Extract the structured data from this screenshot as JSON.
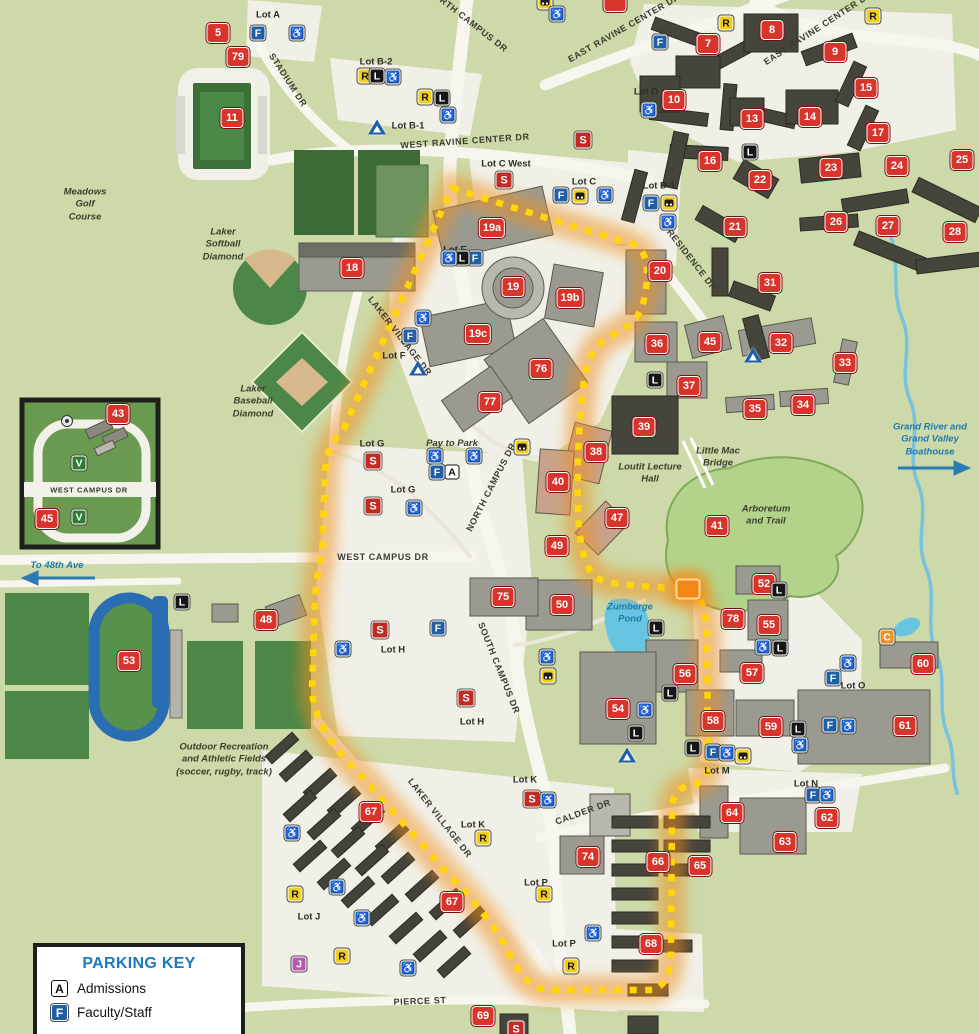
{
  "map": {
    "width": 979,
    "height": 1034
  },
  "colors": {
    "map_green": "#cdd9a8",
    "road_white": "#f6f5ee",
    "field_green": "#4c8747",
    "golf_green": "#3c6b35",
    "building_gray": "#9b9a90",
    "building_dark": "#46453c",
    "badge_red": "#d8342c",
    "badge_blue": "#1f5fa8",
    "badge_yellow": "#f2cf1d",
    "badge_black": "#161616",
    "badge_green": "#2e7d32",
    "badge_purple": "#b55bb5",
    "badge_orange": "#e8922a",
    "route_yellow": "#ffd60a",
    "route_glow": "#ef8e1b",
    "water_blue": "#68c5e2",
    "track_blue": "#2a6db3",
    "label_blue": "#1d7ab0"
  },
  "roads": [
    {
      "label": "NORTH CAMPUS DR",
      "x": 468,
      "y": 20,
      "rot": 38
    },
    {
      "label": "EAST RAVINE CENTER DR",
      "x": 818,
      "y": 28,
      "rot": -33
    },
    {
      "label": "EAST RAVINE CENTER DR",
      "x": 624,
      "y": 28,
      "rot": -30
    },
    {
      "label": "WEST RAVINE CENTER DR",
      "x": 465,
      "y": 141,
      "rot": -4
    },
    {
      "label": "STADIUM DR",
      "x": 288,
      "y": 80,
      "rot": 57
    },
    {
      "label": "RESIDENCE DR",
      "x": 692,
      "y": 260,
      "rot": 52
    },
    {
      "label": "NORTH CAMPUS DR",
      "x": 491,
      "y": 487,
      "rot": -63
    },
    {
      "label": "SOUTH CAMPUS DR",
      "x": 499,
      "y": 668,
      "rot": 68
    },
    {
      "label": "WEST CAMPUS DR",
      "x": 383,
      "y": 557,
      "rot": 0
    },
    {
      "label": "LAKER VILLAGE DR",
      "x": 400,
      "y": 336,
      "rot": 52
    },
    {
      "label": "LAKER VILLAGE DR",
      "x": 440,
      "y": 818,
      "rot": 52
    },
    {
      "label": "CALDER DR",
      "x": 583,
      "y": 812,
      "rot": -20
    },
    {
      "label": "PIERCE ST",
      "x": 420,
      "y": 1001,
      "rot": -2
    },
    {
      "label": "WEST CAMPUS DR",
      "x": 89,
      "y": 490,
      "rot": 0,
      "size": 7.5
    }
  ],
  "lots": [
    {
      "label": "Lot A",
      "x": 268,
      "y": 15
    },
    {
      "label": "Lot B-2",
      "x": 376,
      "y": 62
    },
    {
      "label": "Lot B-1",
      "x": 408,
      "y": 126
    },
    {
      "label": "Lot C West",
      "x": 506,
      "y": 164
    },
    {
      "label": "Lot C",
      "x": 584,
      "y": 182
    },
    {
      "label": "Lot D",
      "x": 646,
      "y": 92
    },
    {
      "label": "Lot D-1",
      "x": 659,
      "y": 186
    },
    {
      "label": "Lot E",
      "x": 455,
      "y": 250
    },
    {
      "label": "Lot F",
      "x": 394,
      "y": 356
    },
    {
      "label": "Lot G",
      "x": 372,
      "y": 444
    },
    {
      "label": "Lot G",
      "x": 403,
      "y": 490
    },
    {
      "label": "Lot H",
      "x": 393,
      "y": 650
    },
    {
      "label": "Lot H",
      "x": 472,
      "y": 722
    },
    {
      "label": "Lot J",
      "x": 309,
      "y": 917
    },
    {
      "label": "Lot K",
      "x": 525,
      "y": 780
    },
    {
      "label": "Lot K",
      "x": 473,
      "y": 825
    },
    {
      "label": "Lot M",
      "x": 717,
      "y": 771
    },
    {
      "label": "Lot N",
      "x": 806,
      "y": 784
    },
    {
      "label": "Lot O",
      "x": 853,
      "y": 686
    },
    {
      "label": "Lot P",
      "x": 536,
      "y": 883
    },
    {
      "label": "Lot P",
      "x": 564,
      "y": 944
    }
  ],
  "places": [
    {
      "label": "Meadows\nGolf\nCourse",
      "x": 85,
      "y": 205,
      "color": "#3a3f2c"
    },
    {
      "label": "Laker\nSoftball\nDiamond",
      "x": 223,
      "y": 245,
      "color": "#3a3f2c"
    },
    {
      "label": "Laker\nBaseball\nDiamond",
      "x": 253,
      "y": 402,
      "color": "#3a3f2c"
    },
    {
      "label": "Loutit Lecture\nHall",
      "x": 650,
      "y": 474,
      "color": "#3a3f2c"
    },
    {
      "label": "Little Mac\nBridge",
      "x": 718,
      "y": 458,
      "color": "#3a3f2c"
    },
    {
      "label": "Arboretum\nand Trail",
      "x": 766,
      "y": 516,
      "color": "#3a3f2c"
    },
    {
      "label": "Grand River and\nGrand Valley\nBoathouse",
      "x": 930,
      "y": 440,
      "color": "#1d7ab0"
    },
    {
      "label": "Zumberge\nPond",
      "x": 630,
      "y": 614,
      "color": "#1d7ab0"
    },
    {
      "label": "To 48th Ave",
      "x": 57,
      "y": 566,
      "color": "#1d7ab0"
    },
    {
      "label": "Outdoor Recreation\nand Athletic Fields\n(soccer, rugby, track)",
      "x": 224,
      "y": 760,
      "color": "#3a3f2c"
    },
    {
      "label": "Pay to Park",
      "x": 452,
      "y": 444,
      "color": "#3a3f2c"
    }
  ],
  "badges": [
    [
      "n",
      "5",
      218,
      33
    ],
    [
      "n",
      "79",
      238,
      57
    ],
    [
      "n",
      "11",
      232,
      118
    ],
    [
      "n",
      "18",
      352,
      268
    ],
    [
      "n",
      "19a",
      492,
      228
    ],
    [
      "n",
      "19",
      513,
      287
    ],
    [
      "n",
      "19b",
      570,
      298
    ],
    [
      "n",
      "19c",
      478,
      334
    ],
    [
      "n",
      "76",
      541,
      369
    ],
    [
      "n",
      "77",
      490,
      402
    ],
    [
      "n",
      "7",
      708,
      44
    ],
    [
      "n",
      "8",
      772,
      30
    ],
    [
      "n",
      "9",
      835,
      52
    ],
    [
      "n",
      "10",
      674,
      100
    ],
    [
      "n",
      "13",
      752,
      119
    ],
    [
      "n",
      "14",
      810,
      117
    ],
    [
      "n",
      "15",
      866,
      88
    ],
    [
      "n",
      "16",
      710,
      161
    ],
    [
      "n",
      "17",
      878,
      133
    ],
    [
      "n",
      "20",
      660,
      271
    ],
    [
      "n",
      "21",
      735,
      227
    ],
    [
      "n",
      "22",
      760,
      180
    ],
    [
      "n",
      "23",
      831,
      168
    ],
    [
      "n",
      "24",
      897,
      166
    ],
    [
      "n",
      "25",
      962,
      160
    ],
    [
      "n",
      "26",
      836,
      222
    ],
    [
      "n",
      "27",
      888,
      226
    ],
    [
      "n",
      "28",
      955,
      232
    ],
    [
      "n",
      "31",
      770,
      283
    ],
    [
      "n",
      "32",
      781,
      343
    ],
    [
      "n",
      "33",
      845,
      363
    ],
    [
      "n",
      "34",
      803,
      405
    ],
    [
      "n",
      "35",
      755,
      409
    ],
    [
      "n",
      "36",
      657,
      344
    ],
    [
      "n",
      "37",
      689,
      386
    ],
    [
      "n",
      "38",
      596,
      452
    ],
    [
      "n",
      "39",
      644,
      427
    ],
    [
      "n",
      "40",
      558,
      482
    ],
    [
      "n",
      "41",
      717,
      526
    ],
    [
      "n",
      "43",
      118,
      414
    ],
    [
      "n",
      "45",
      710,
      342
    ],
    [
      "n",
      "45",
      47,
      519
    ],
    [
      "n",
      "47",
      617,
      518
    ],
    [
      "n",
      "48",
      266,
      620
    ],
    [
      "n",
      "49",
      557,
      546
    ],
    [
      "n",
      "50",
      562,
      605
    ],
    [
      "n",
      "52",
      764,
      584
    ],
    [
      "n",
      "53",
      129,
      661
    ],
    [
      "n",
      "54",
      618,
      709
    ],
    [
      "n",
      "55",
      769,
      625
    ],
    [
      "n",
      "56",
      685,
      674
    ],
    [
      "n",
      "57",
      752,
      673
    ],
    [
      "n",
      "58",
      713,
      721
    ],
    [
      "n",
      "59",
      771,
      727
    ],
    [
      "n",
      "60",
      923,
      664
    ],
    [
      "n",
      "61",
      905,
      726
    ],
    [
      "n",
      "62",
      827,
      818
    ],
    [
      "n",
      "63",
      785,
      842
    ],
    [
      "n",
      "64",
      732,
      813
    ],
    [
      "n",
      "65",
      700,
      866
    ],
    [
      "n",
      "66",
      658,
      862
    ],
    [
      "n",
      "67",
      371,
      812
    ],
    [
      "n",
      "67",
      452,
      902
    ],
    [
      "n",
      "68",
      651,
      944
    ],
    [
      "n",
      "69",
      483,
      1016
    ],
    [
      "n",
      "74",
      588,
      857
    ],
    [
      "n",
      "75",
      503,
      597
    ],
    [
      "n",
      "78",
      733,
      619
    ],
    [
      "n",
      "",
      615,
      2
    ],
    [
      "g",
      "",
      688,
      589
    ],
    [
      "s",
      "S",
      583,
      140
    ],
    [
      "s",
      "S",
      504,
      180
    ],
    [
      "s",
      "S",
      373,
      461
    ],
    [
      "s",
      "S",
      373,
      506
    ],
    [
      "s",
      "S",
      380,
      630
    ],
    [
      "s",
      "S",
      466,
      698
    ],
    [
      "s",
      "S",
      532,
      799
    ],
    [
      "s",
      "S",
      516,
      1029
    ],
    [
      "f",
      "F",
      258,
      33
    ],
    [
      "f",
      "F",
      660,
      42
    ],
    [
      "f",
      "F",
      561,
      195
    ],
    [
      "f",
      "F",
      651,
      203
    ],
    [
      "f",
      "F",
      475,
      258
    ],
    [
      "f",
      "F",
      410,
      336
    ],
    [
      "f",
      "F",
      437,
      472
    ],
    [
      "f",
      "F",
      438,
      628
    ],
    [
      "f",
      "F",
      833,
      678
    ],
    [
      "f",
      "F",
      830,
      725
    ],
    [
      "f",
      "F",
      713,
      752
    ],
    [
      "f",
      "F",
      813,
      795
    ],
    [
      "r",
      "R",
      365,
      76
    ],
    [
      "r",
      "R",
      425,
      97
    ],
    [
      "r",
      "R",
      726,
      23
    ],
    [
      "r",
      "R",
      873,
      16
    ],
    [
      "r",
      "R",
      483,
      838
    ],
    [
      "r",
      "R",
      544,
      894
    ],
    [
      "r",
      "R",
      571,
      966
    ],
    [
      "r",
      "R",
      295,
      894
    ],
    [
      "r",
      "R",
      342,
      956
    ],
    [
      "l",
      "L",
      377,
      76
    ],
    [
      "l",
      "L",
      442,
      98
    ],
    [
      "l",
      "L",
      750,
      152
    ],
    [
      "l",
      "L",
      182,
      602
    ],
    [
      "l",
      "L",
      462,
      258
    ],
    [
      "l",
      "L",
      655,
      380
    ],
    [
      "l",
      "L",
      656,
      628
    ],
    [
      "l",
      "L",
      779,
      590
    ],
    [
      "l",
      "L",
      780,
      648
    ],
    [
      "l",
      "L",
      670,
      693
    ],
    [
      "l",
      "L",
      636,
      733
    ],
    [
      "l",
      "L",
      693,
      748
    ],
    [
      "l",
      "L",
      798,
      729
    ],
    [
      "a",
      "A",
      452,
      472
    ],
    [
      "v",
      "V",
      79,
      463
    ],
    [
      "v",
      "V",
      79,
      517
    ],
    [
      "j",
      "J",
      299,
      964
    ],
    [
      "c",
      "C",
      887,
      637
    ],
    [
      "b",
      "",
      545,
      2
    ],
    [
      "b",
      "",
      580,
      196
    ],
    [
      "b",
      "",
      669,
      203
    ],
    [
      "b",
      "",
      522,
      447
    ],
    [
      "b",
      "",
      548,
      676
    ],
    [
      "b",
      "",
      743,
      756
    ],
    [
      "w",
      "",
      297,
      33
    ],
    [
      "w",
      "",
      557,
      14
    ],
    [
      "w",
      "",
      393,
      77
    ],
    [
      "w",
      "",
      448,
      115
    ],
    [
      "w",
      "",
      605,
      195
    ],
    [
      "w",
      "",
      649,
      110
    ],
    [
      "w",
      "",
      668,
      222
    ],
    [
      "w",
      "",
      449,
      258
    ],
    [
      "w",
      "",
      423,
      318
    ],
    [
      "w",
      "",
      435,
      456
    ],
    [
      "w",
      "",
      474,
      456
    ],
    [
      "w",
      "",
      414,
      508
    ],
    [
      "w",
      "",
      343,
      649
    ],
    [
      "w",
      "",
      547,
      657
    ],
    [
      "w",
      "",
      645,
      710
    ],
    [
      "w",
      "",
      763,
      647
    ],
    [
      "w",
      "",
      727,
      753
    ],
    [
      "w",
      "",
      800,
      745
    ],
    [
      "w",
      "",
      848,
      663
    ],
    [
      "w",
      "",
      848,
      726
    ],
    [
      "w",
      "",
      827,
      795
    ],
    [
      "w",
      "",
      593,
      933
    ],
    [
      "w",
      "",
      292,
      833
    ],
    [
      "w",
      "",
      337,
      887
    ],
    [
      "w",
      "",
      362,
      918
    ],
    [
      "w",
      "",
      408,
      968
    ],
    [
      "w",
      "",
      548,
      800
    ],
    [
      "p",
      "",
      377,
      127
    ],
    [
      "p",
      "",
      418,
      368
    ],
    [
      "p",
      "",
      753,
      355
    ],
    [
      "p",
      "",
      627,
      755
    ]
  ],
  "parking_key": {
    "title": "PARKING KEY",
    "entries": [
      {
        "icon": "A",
        "label": "Admissions"
      },
      {
        "icon": "F",
        "label": "Faculty/Staff"
      }
    ]
  }
}
